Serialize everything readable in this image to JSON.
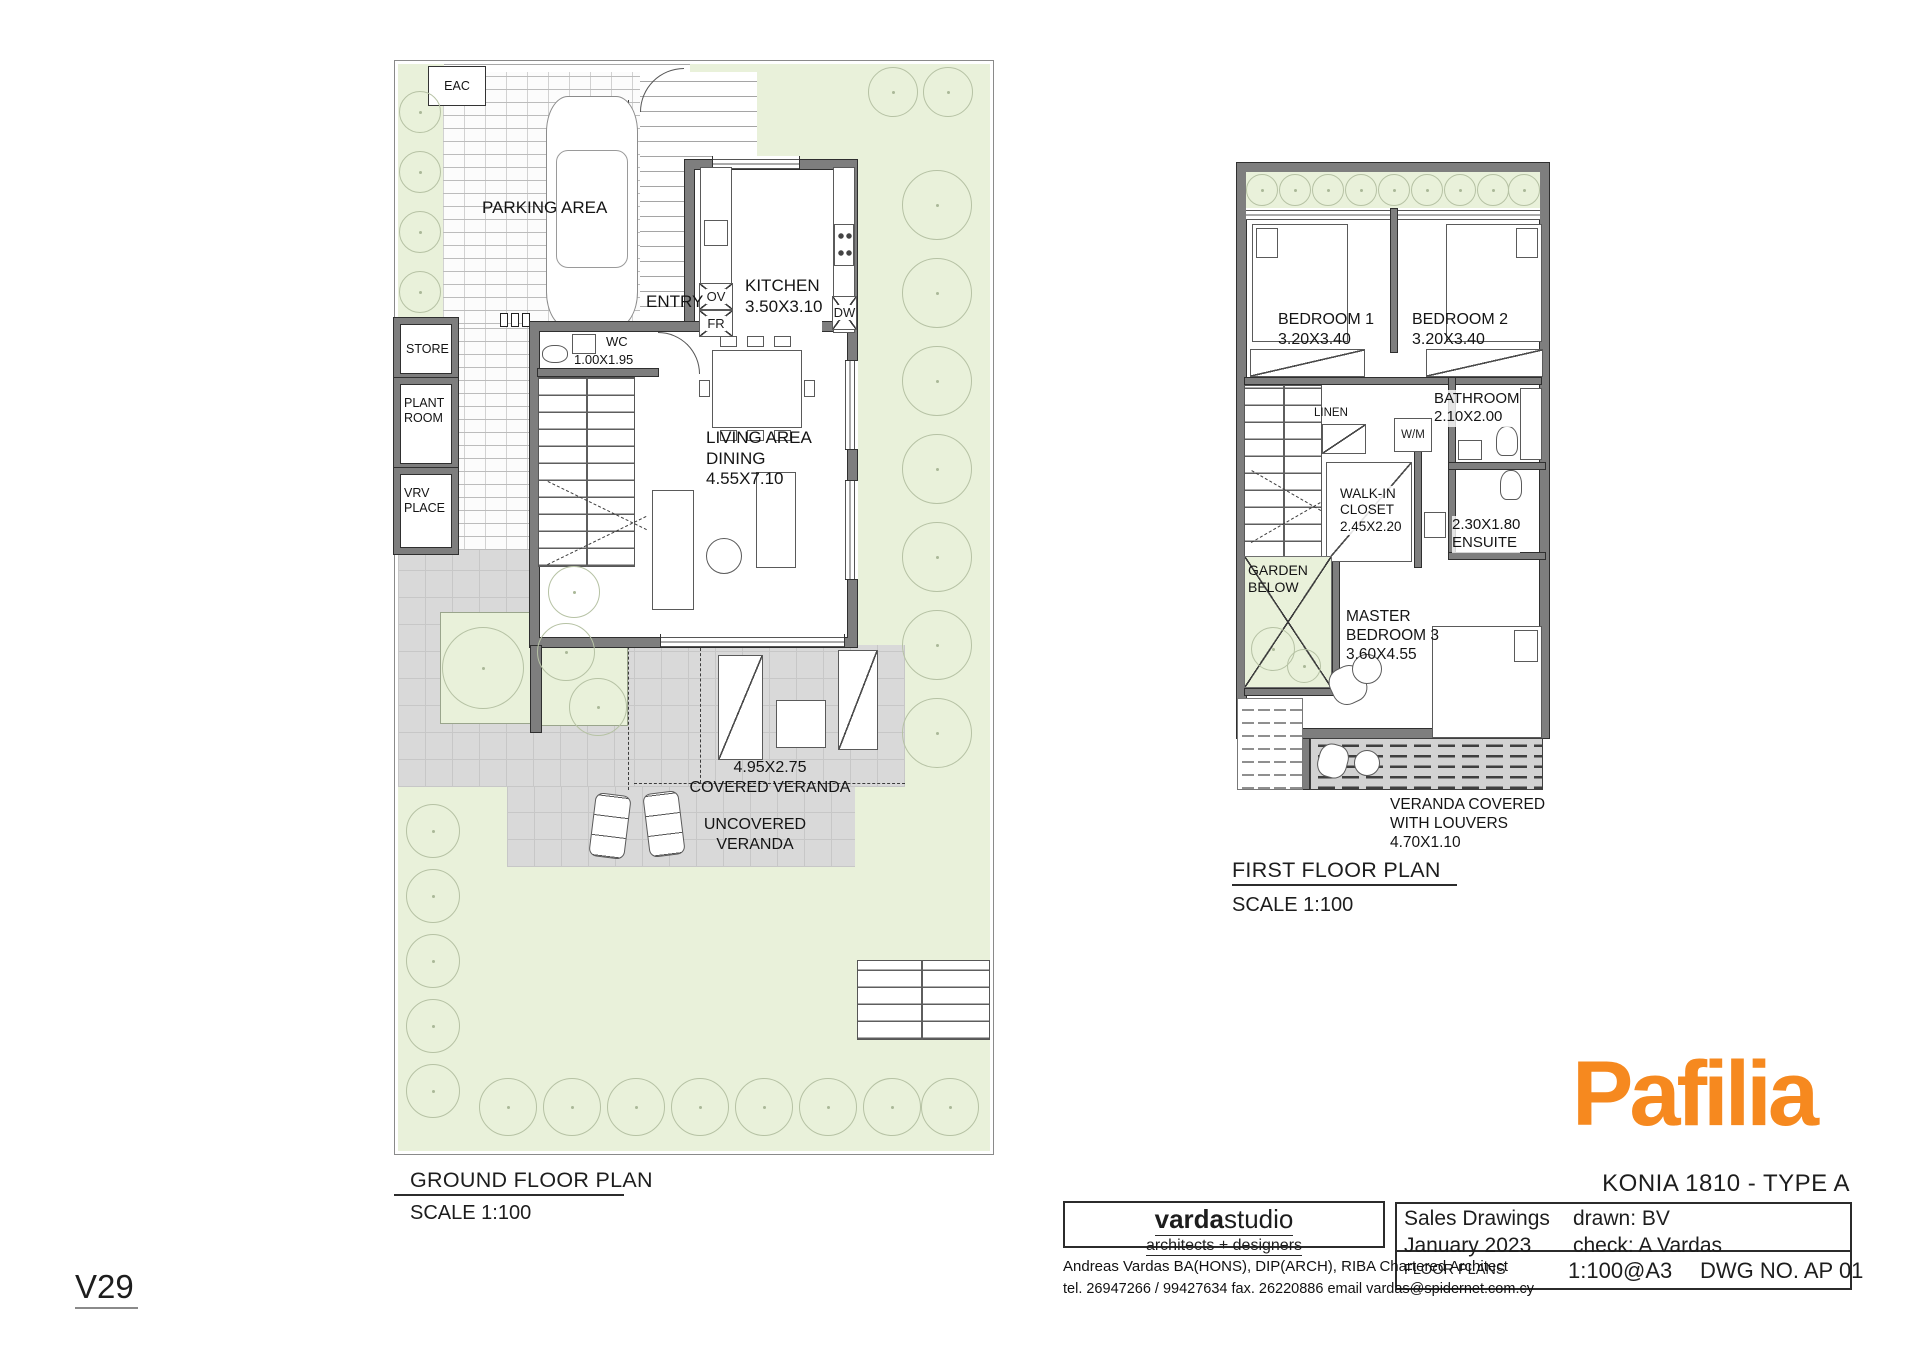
{
  "ground_floor": {
    "title": "GROUND FLOOR PLAN",
    "scale": "SCALE 1:100",
    "labels": {
      "eac": "EAC",
      "parking_area": "PARKING AREA",
      "entry": "ENTRY",
      "kitchen": "KITCHEN\n3.50X3.10",
      "oven": "OV",
      "fridge": "FR",
      "dishwasher": "DW",
      "store": "STORE",
      "wc": "WC",
      "wc_dim": "1.00X1.95",
      "plant_room": "PLANT\nROOM",
      "vrv_place": "VRV\nPLACE",
      "living": "LIVING AREA\nDINING\n4.55X7.10",
      "covered_veranda": "4.95X2.75\nCOVERED VERANDA",
      "uncovered_veranda": "UNCOVERED\nVERANDA"
    }
  },
  "first_floor": {
    "title": "FIRST FLOOR PLAN",
    "scale": "SCALE 1:100",
    "labels": {
      "bedroom1": "BEDROOM 1\n3.20X3.40",
      "bedroom2": "BEDROOM 2\n3.20X3.40",
      "bathroom": "BATHROOM\n2.10X2.00",
      "linen": "LINEN",
      "washing_machine": "W/M",
      "walk_in_closet": "WALK-IN\nCLOSET\n2.45X2.20",
      "ensuite": "2.30X1.80\nENSUITE",
      "garden_below": "GARDEN\nBELOW",
      "master_bedroom": "MASTER\nBEDROOM 3\n3.60X4.55",
      "veranda_louvers": "VERANDA COVERED\nWITH LOUVERS\n4.70X1.10"
    }
  },
  "title_block": {
    "brand": "Pafilia",
    "project": "KONIA 1810 - TYPE A",
    "row1_left": "Sales Drawings\nJanuary 2023",
    "drawn_check": "drawn: BV\ncheck: A Vardas",
    "row2_left": "FLOOR PLANS",
    "print_scale": "1:100@A3",
    "dwg_no": "DWG NO. AP 01"
  },
  "studio": {
    "name_bold": "varda",
    "name_rest": "studio",
    "tagline": "architects + designers",
    "line1": "Andreas Vardas BA(HONS), DIP(ARCH), RIBA Chartered Architect",
    "line2": "tel. 26947266 / 99427634 fax. 26220886 email vardas@spidernet.com.cy"
  },
  "revision": "V29",
  "colors": {
    "brand_orange": "#F6891F",
    "garden_green": "#E9F1DA",
    "paving_gray": "#D9D9D9",
    "wall_gray": "#7E7E7E"
  }
}
